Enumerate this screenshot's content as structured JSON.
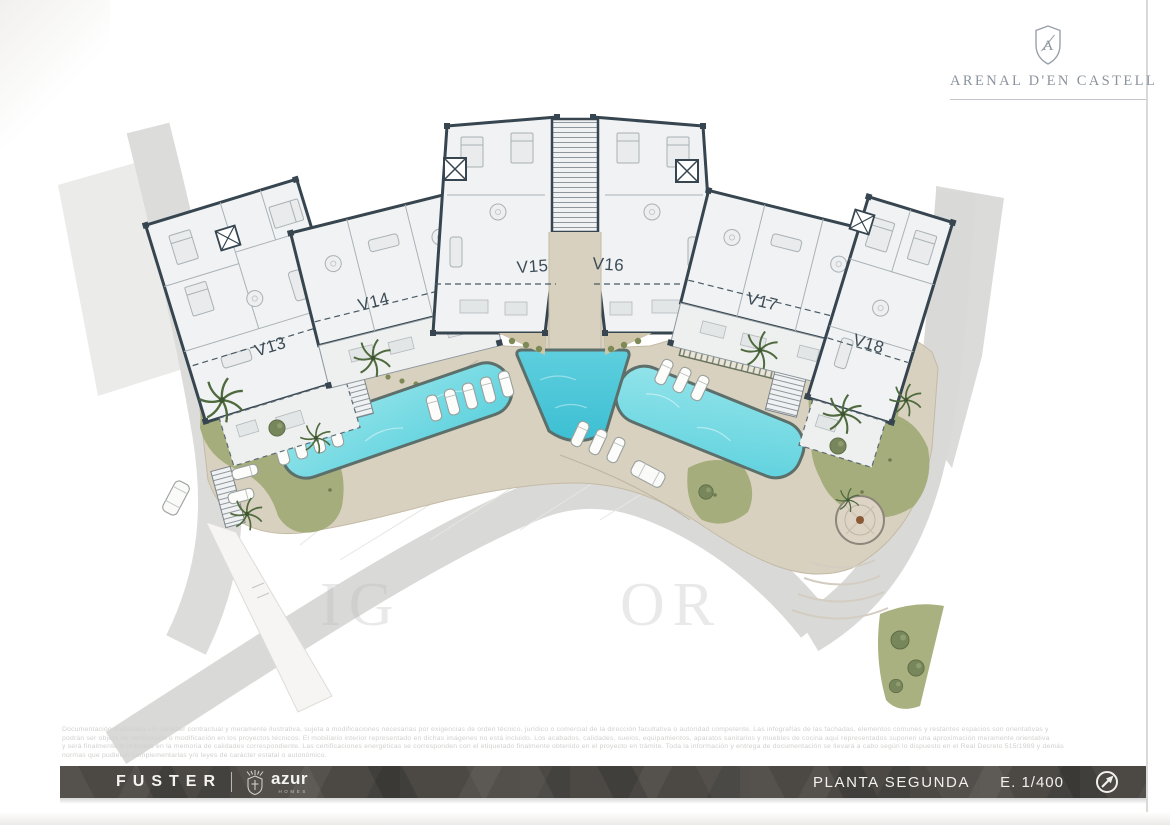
{
  "header": {
    "brand": "ARENAL D'EN CASTELL",
    "monogram": "A"
  },
  "plan": {
    "units": [
      {
        "label": "V13"
      },
      {
        "label": "V14"
      },
      {
        "label": "V15"
      },
      {
        "label": "V16"
      },
      {
        "label": "V17"
      },
      {
        "label": "V18"
      }
    ]
  },
  "watermark": {
    "left": "IG",
    "right": "OR"
  },
  "disclaimer": {
    "line1": "Documentación elaborada sin carácter contractual y meramente ilustrativa, sujeta a modificaciones necesarias por exigencias de orden técnico, jurídico o comercial de la dirección facultativa o autoridad competente. Las infografías de las fachadas, elementos comunes y restantes espacios son orientativas y",
    "line2": "podrán ser objeto de verificación o modificación en los proyectos técnicos. El mobiliario interior representado en dichas imágenes no está incluido. Los acabados, calidades, suelos, equipamientos, aparatos sanitarios y muebles de cocina aquí representados suponen una aproximación meramente orientativa",
    "line3": "y será finalmente lo indicado en la memoria de calidades correspondiente. Las certificaciones energéticas se corresponden con el etiquetado finalmente obtenido en el proyecto en trámite. Toda la información y entrega de documentación se llevará a cabo según lo dispuesto en el Real Decreto 515/1989 y demás",
    "line4": "normas que pudieran complementarlas y/o leyes de carácter estatal o autonómico."
  },
  "footer": {
    "developer": "FUSTER",
    "brand": "azur",
    "brand_sub": "HOMES",
    "plan_name": "PLANTA SEGUNDA",
    "scale": "E. 1/400"
  }
}
